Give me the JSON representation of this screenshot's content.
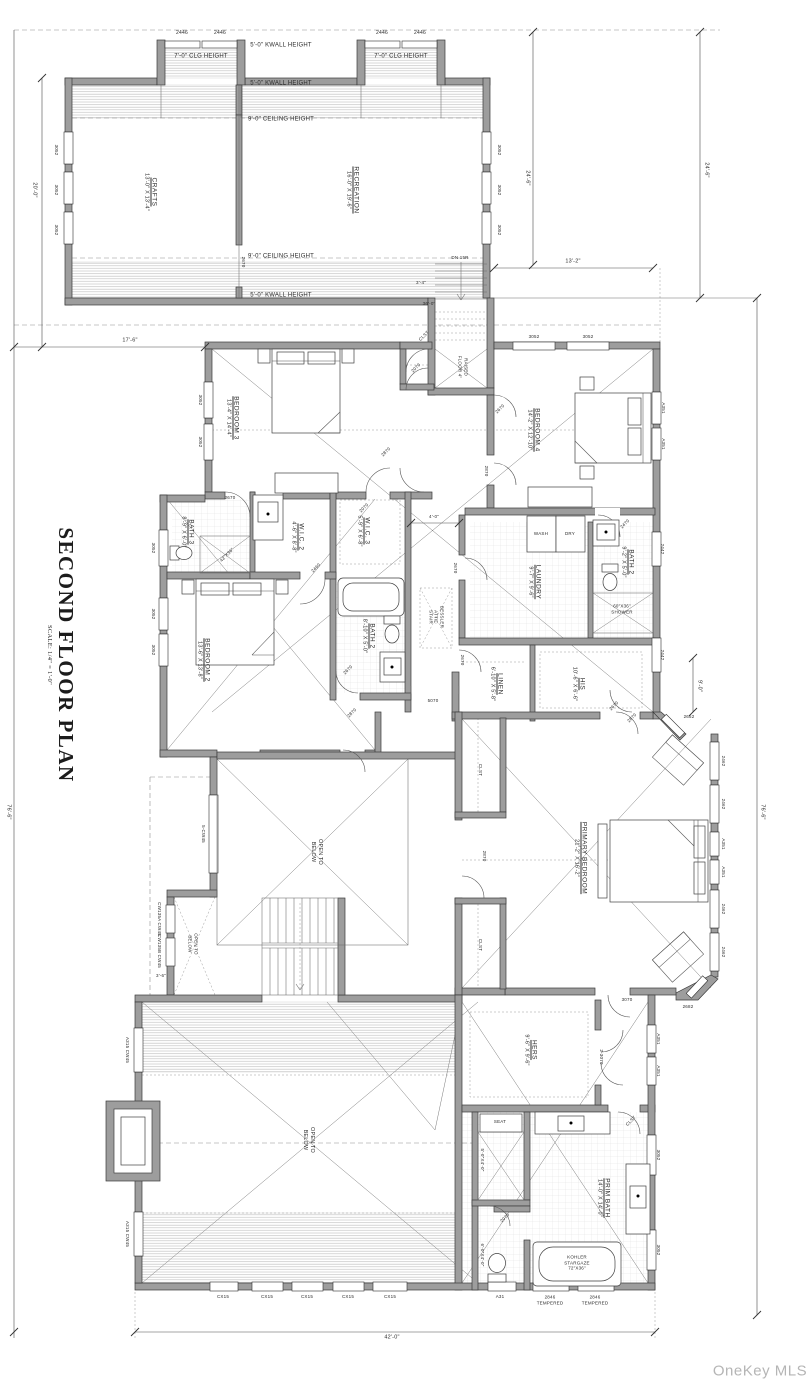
{
  "title": {
    "heading": "SECOND FLOOR PLAN",
    "scale": "SCALE: 1/4\" = 1'-0\""
  },
  "watermark": "OneKey MLS",
  "rooms": {
    "crafts": {
      "name": "CRAFTS",
      "dims": "13'-0\" X 13'-4\""
    },
    "recreation": {
      "name": "RECREATION",
      "dims": "16'-0\" X 19'-6\""
    },
    "bedroom3": {
      "name": "BEDROOM 3",
      "dims": "13'-4\" X 14'-4\""
    },
    "bedroom4": {
      "name": "BEDROOM 4",
      "dims": "14'-2\" X 12'-10\""
    },
    "bedroom2": {
      "name": "BEDROOM 2",
      "dims": "13'-6\" X 13'-8\""
    },
    "bath3": {
      "name": "BATH 3",
      "dims": "8'-9\" X 6'-0\""
    },
    "bath2_middle": {
      "name": "BATH 2",
      "dims": "8'-10\" X 5'-0\""
    },
    "bath2_right": {
      "name": "BATH 2",
      "dims": "9'-2\" X 5'-0\""
    },
    "wic2": {
      "name": "W.I.C. 2",
      "dims": "4'-6\" X 8'-8\""
    },
    "wic3": {
      "name": "W.I.C. 3",
      "dims": "5'-9\" X 6'-8\""
    },
    "laundry": {
      "name": "LAUNDRY",
      "dims": "9'-7\" X 9'-6\""
    },
    "linen": {
      "name": "LINEN",
      "dims": "6'-10\" X 5'-8\""
    },
    "his": {
      "name": "HIS",
      "dims": "10'-6\" X 6'-6\""
    },
    "hers": {
      "name": "HERS",
      "dims": "9'-6\" X 9'-6\""
    },
    "primary": {
      "name": "PRIMARY BEDROOM",
      "dims": "21'-2\" X 16'-2\""
    },
    "prim_bath": {
      "name": "PRIM BATH",
      "dims": "14'-0\" X 14'-0\""
    }
  },
  "annotations": {
    "open1": "OPEN TO",
    "open2": "BELOW",
    "attic1": "BESSLER",
    "attic2": "ATTIC",
    "attic3": "STAIR",
    "raised1": "RAISED",
    "raised2": "FLOOR 4\"",
    "stairs_dn": "DN 15R"
  },
  "fixtures": {
    "wash": "WASH",
    "dry": "DRY",
    "seat": "SEAT",
    "shower60_1": "60\"X36\"",
    "shower60_2": "SHOWER",
    "shower42": "42\"X36\"",
    "tub1": "KOHLER",
    "tub2": "STARGAZE",
    "tub3": "72\"X36\"",
    "seat_dim": "5'-0\"X4'-0\"",
    "wc_dim": "6'-0\"X4'-0\"",
    "closet": "CLST"
  },
  "heights": {
    "clg7": "7'-0\" CLG HEIGHT",
    "kwall5": "5'-0\" KWALL HEIGHT",
    "ceil9": "9'-0\" CEILING HEIGHT"
  },
  "dims": {
    "d2446": "2446",
    "d24_6": "24'-6\"",
    "d13_2": "13'-2\"",
    "d20_0": "20'-0\"",
    "d17_6": "17'-6\"",
    "d76_6": "76'-6\"",
    "d42_0": "42'-0\"",
    "d3_4": "3'-4\"",
    "d36_0": "36'-0\"",
    "d4_0": "4'-0\"",
    "d9_0": "9'-0\"",
    "d3_6": "3'-6\""
  },
  "windows": {
    "w3052": "3052",
    "w2442": "2442",
    "wA351": "A351",
    "w2462": "2462",
    "w2652": "2652",
    "w2682": "2682",
    "w2846": "2846",
    "tempered": "TEMPERED",
    "wA31": "A31",
    "cx15": "CX15",
    "a315": "A315 CW45",
    "cw5": "5-CW45",
    "cw135a": "CW135A CW45",
    "cw135b": "CW135B CW45"
  },
  "doors": {
    "d2870": "2870",
    "d2070": "2070",
    "d2670": "2670",
    "d2460": "2460",
    "d2470": "2470",
    "d3070": "3070",
    "d2_3070": "2-3070",
    "d5070": "5070"
  }
}
